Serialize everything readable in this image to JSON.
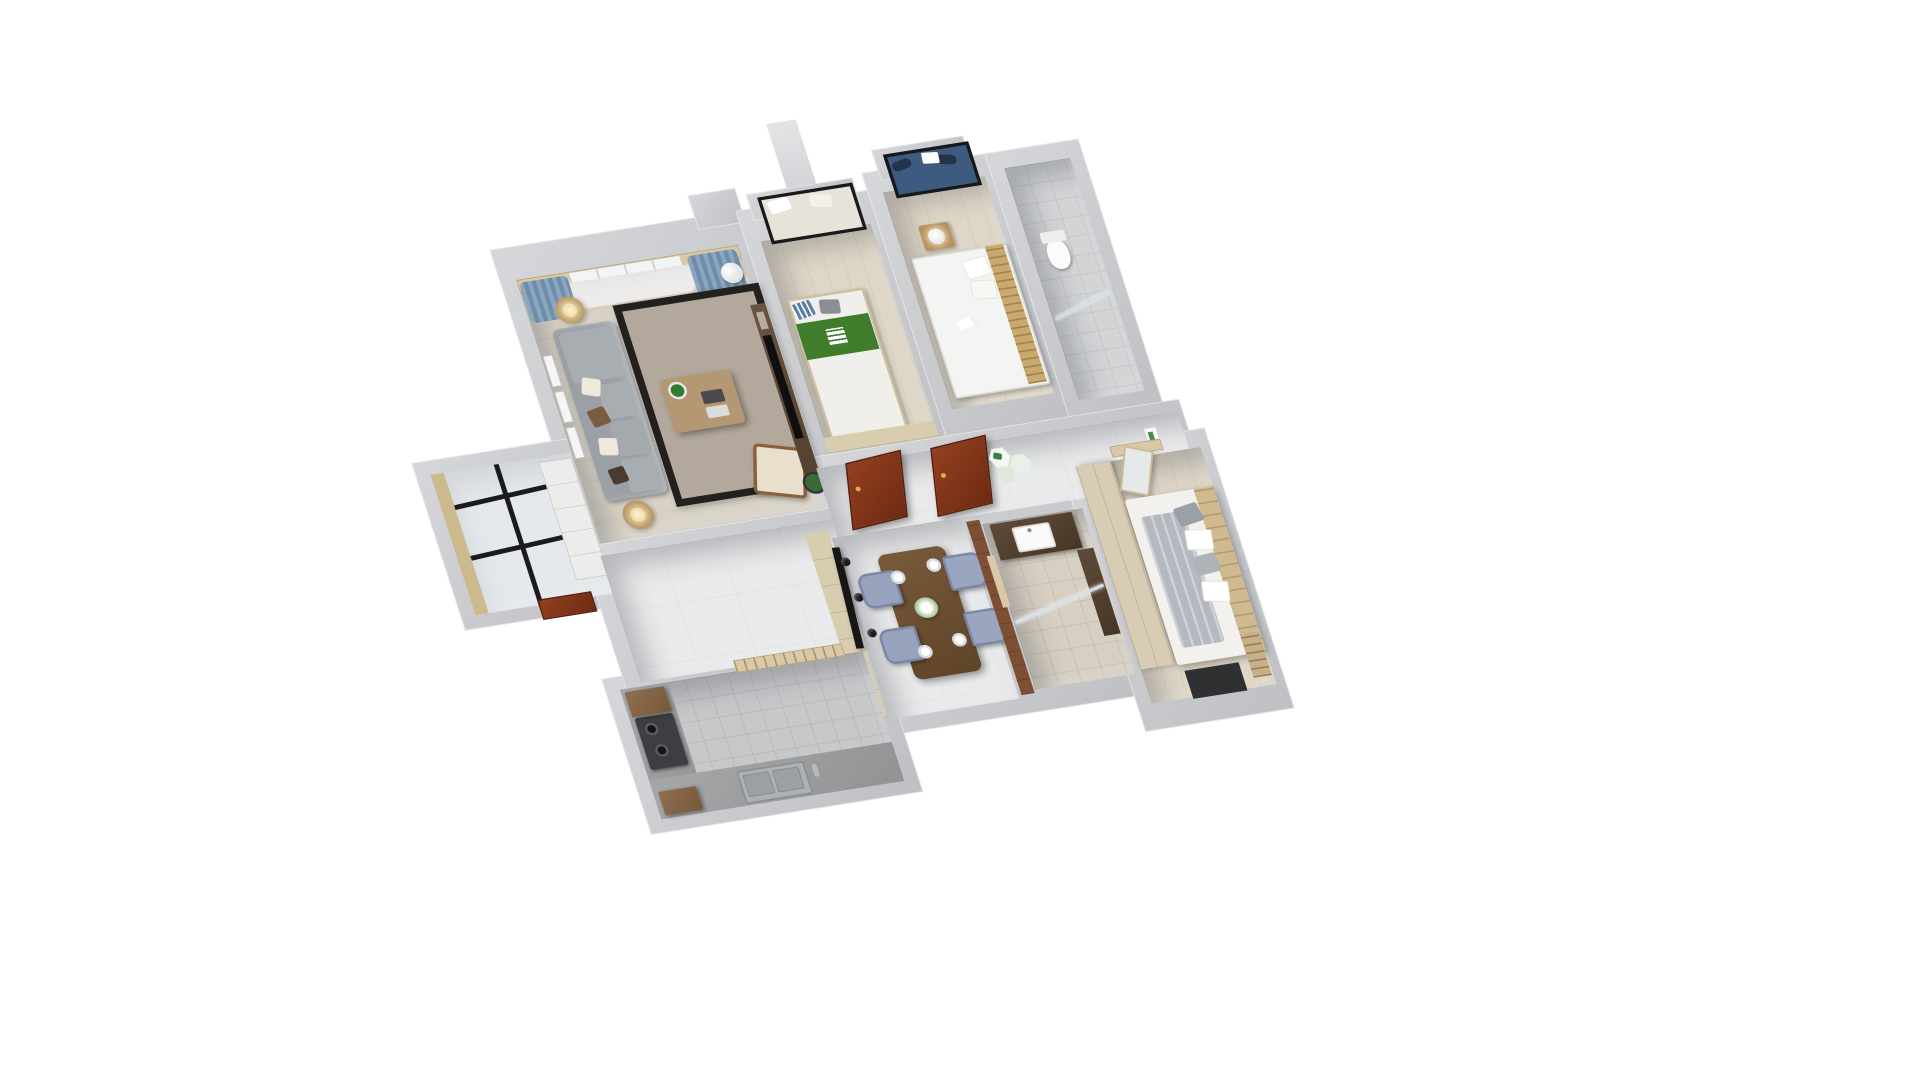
{
  "image_type": "3d-floor-plan-render",
  "title": "3D apartment floor plan render, axonometric top view on white background",
  "palette": {
    "background": "#ffffff",
    "wall_gray": "#c9cacd",
    "wall_top_light": "#e9eaec",
    "marble_floor": "#e9eaeb",
    "wood_floor": "#ded6c6",
    "kitchen_tile": "#c7c8ca",
    "sofa_gray": "#9aa0a6",
    "curtain_blue": "#7f9cb8",
    "door_redwood": "#7e3318",
    "bed_green_blanket": "#3f7d2b",
    "dining_chair_blue": "#97a2bd",
    "table_walnut": "#6b4f33",
    "vanity_walnut": "#5a4636",
    "accent_plant_green": "#2e7d32",
    "cabinet_lightwood": "#d9cdb0"
  },
  "rooms": {
    "living_room": {
      "label": "Living room",
      "furniture": [
        "gray fabric sofa with chaise and pillows",
        "wood coffee table with potted plant and trays",
        "taupe rug with black border",
        "cream accent chair with walnut frame",
        "two round side tables with lamps",
        "TV wall with flat TV and bicycle wall art",
        "floor plant",
        "white tower air conditioner",
        "french window wall with blue curtains and sheers",
        "picture frames on west wall"
      ]
    },
    "service_balcony": {
      "label": "Service balcony / entry",
      "furniture": [
        "glass skylight roof with black frames",
        "built-in white cabinets",
        "wood trim column",
        "red-brown entry door"
      ]
    },
    "bedroom_2": {
      "label": "Bedroom 2",
      "furniture": [
        "bay window with black frame and seat pillows",
        "double bed with green blanket runner and striped blue pillow",
        "low light-wood dresser band"
      ]
    },
    "bedroom_3": {
      "label": "Bedroom 3",
      "furniture": [
        "bay window with dark blue cushion",
        "white double bed with open book",
        "wood slat headboard",
        "light-wood nightstand with white drum lamp"
      ]
    },
    "bathroom_1": {
      "label": "Bathroom 1",
      "furniture": [
        "white toilet",
        "glass shower partition",
        "gray floor tile"
      ]
    },
    "hallway": {
      "label": "Hallway",
      "furniture": [
        "two open red-brown wooden doors",
        "hexagon wall decor with green leaves",
        "small botanical frames",
        "white marble floor"
      ]
    },
    "bathroom_2": {
      "label": "Bathroom 2",
      "furniture": [
        "dark walnut vanity with white basin",
        "tall walnut cabinet",
        "mirror",
        "glass shower screen",
        "light wood door frame"
      ]
    },
    "master_bedroom": {
      "label": "Master bedroom",
      "furniture": [
        "large double bed with folded gray duvet and pillow group",
        "light-wood wardrobe slab",
        "frosted glass door ajar",
        "wood headboard wall",
        "dark balcony doorway",
        "small bookshelf"
      ]
    },
    "dining_area": {
      "label": "Dining area",
      "furniture": [
        "dark walnut dining table",
        "4 blue-gray upholstered chairs",
        "4 white place settings",
        "white flower centerpiece",
        "black ceiling track light with 3 spots",
        "tall light-wood sideboard"
      ]
    },
    "kitchen": {
      "label": "Kitchen",
      "furniture": [
        "L-shaped concrete-gray counter",
        "dark gas cooktop with burners",
        "double stainless sink with faucet",
        "brown upper cabinets",
        "window with wood frame and drying rack",
        "gray floor tile"
      ]
    }
  },
  "counts": {
    "bedrooms": 3,
    "bathrooms": 2,
    "dining_chairs": 4,
    "place_settings": 4,
    "hall_doors": 2,
    "hex_decor": 3
  },
  "view": {
    "projection": "axonometric, rotated about -9 degrees, seen from above",
    "walls": "white-gray cut walls with visible thickness",
    "background": "pure white"
  }
}
